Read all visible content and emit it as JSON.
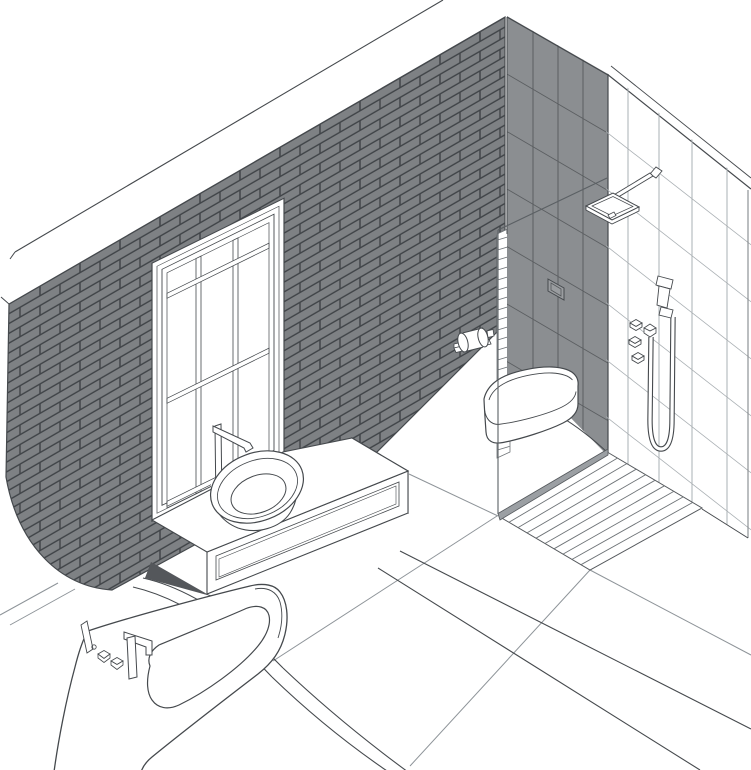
{
  "scene": {
    "title": "Isometric bathroom line illustration",
    "style": "technical architectural drawing, grey line art on white",
    "elements": [
      "ceiling-edge",
      "brick-accent-wall",
      "paned-window",
      "wall-end-cap",
      "dark-tile-shower-wall",
      "white-tile-side-wall",
      "glass-shower-screen",
      "rain-shower-head",
      "hand-shower-with-hose",
      "shower-valves",
      "flush-plate",
      "wall-hung-toilet",
      "toilet-paper-holder",
      "teak-shower-floor-mat",
      "tiled-floor",
      "floating-vanity",
      "vessel-sink",
      "basin-faucet",
      "bathtub",
      "bath-filler-faucet",
      "bath-valve-knobs",
      "floor-step-edge"
    ]
  },
  "colors": {
    "background": "#ffffff",
    "line_dark": "#45494d",
    "line_mid": "#6e7377",
    "line_light": "#9aa0a5",
    "floor_grout": "#8e9499",
    "brick_fill": "#7e8184",
    "brick_mortar": "#3f4347",
    "dark_tile_fill": "#8b8e91",
    "dark_tile_grout": "#5b5e61",
    "glass_base_steel": "#9b9fa3",
    "shadow": "#54575b"
  }
}
